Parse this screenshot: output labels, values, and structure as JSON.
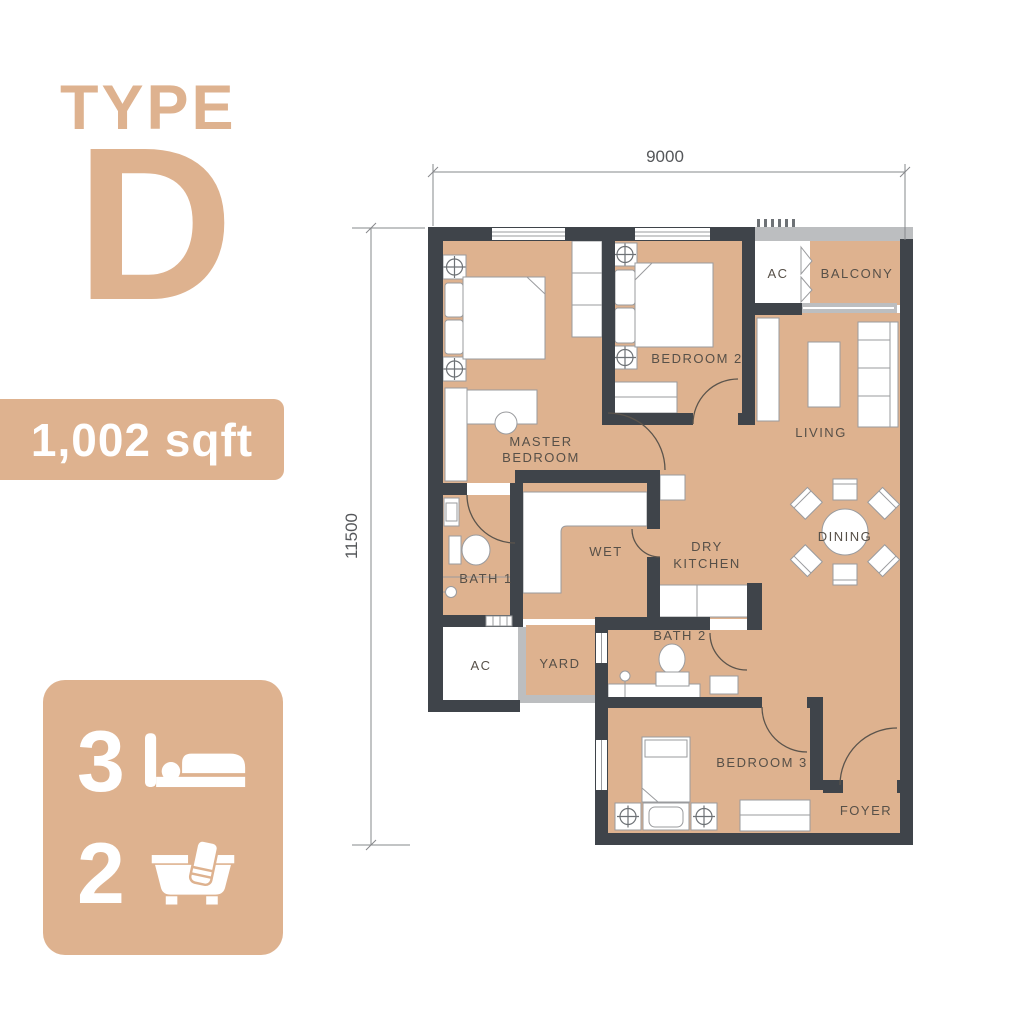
{
  "colors": {
    "accent_tan": "#DEB28F",
    "floor_tan": "#DEB28F",
    "wall_dark": "#3F444A",
    "wall_light": "#BCBEC0",
    "label_text": "#575048",
    "dim_text": "#55575A",
    "white": "#FFFFFF"
  },
  "panel": {
    "type_label": "TYPE",
    "type_letter": "D",
    "area": "1,002 sqft",
    "bed_count": "3",
    "bath_count": "2"
  },
  "plan": {
    "dim_top": "9000",
    "dim_left": "11500",
    "labels": {
      "master_1": "MASTER",
      "master_2": "BEDROOM",
      "bedroom2": "BEDROOM 2",
      "bedroom3": "BEDROOM 3",
      "living": "LIVING",
      "dining": "DINING",
      "dry_1": "DRY",
      "dry_2": "KITCHEN",
      "wet": "WET",
      "bath1": "BATH 1",
      "bath2": "BATH 2",
      "yard": "YARD",
      "ac_top": "AC",
      "ac_bottom": "AC",
      "balcony": "BALCONY",
      "foyer": "FOYER"
    }
  }
}
